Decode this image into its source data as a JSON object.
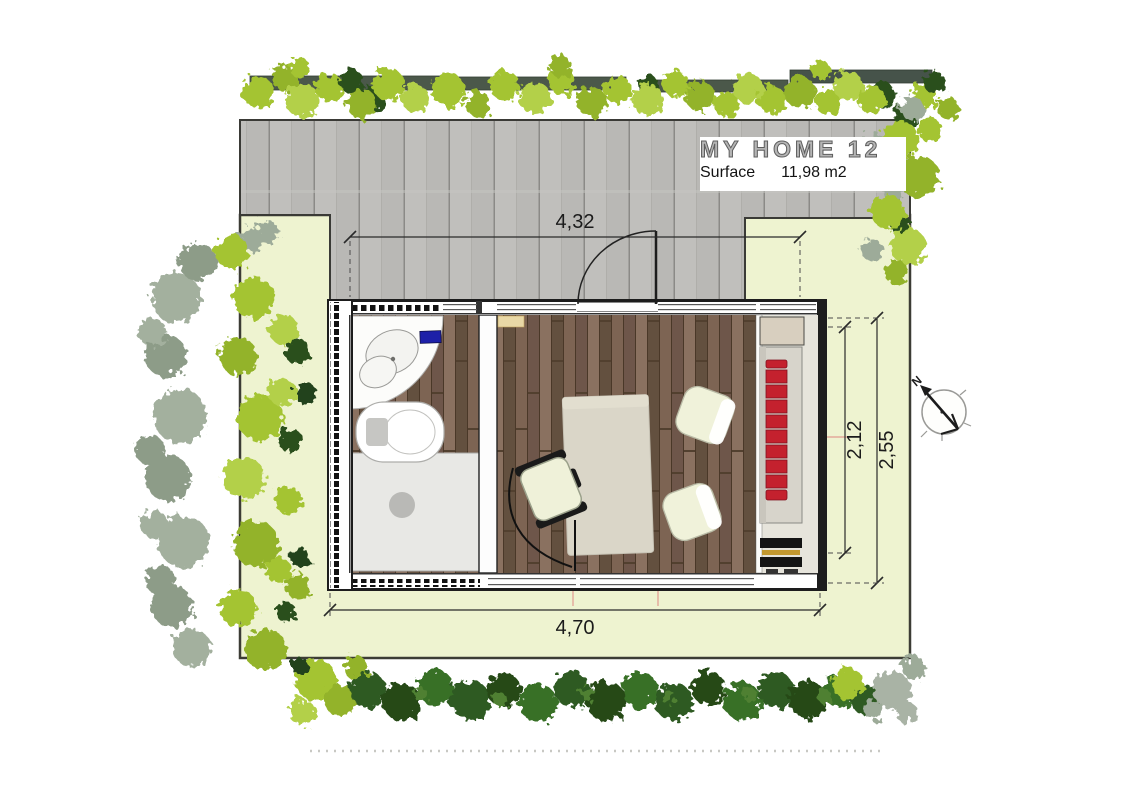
{
  "title_block": {
    "title": "MY HOME 12",
    "surface_label": "Surface",
    "surface_value": "11,98 m2"
  },
  "dimensions": {
    "width_top": "4,32",
    "width_bottom": "4,70",
    "depth_outer": "2,55",
    "depth_inner": "2,12"
  },
  "compass": {
    "north_label": "N"
  },
  "colors": {
    "lawn": "#eef3d0",
    "deck_gray": "#b9b8b5",
    "wood_floor": "#7b6354",
    "sofa_red": "#c4212e",
    "foliage_light": "#a4c433",
    "foliage_dark": "#2e5a21",
    "bath_mat_blue": "#1d20a8"
  }
}
